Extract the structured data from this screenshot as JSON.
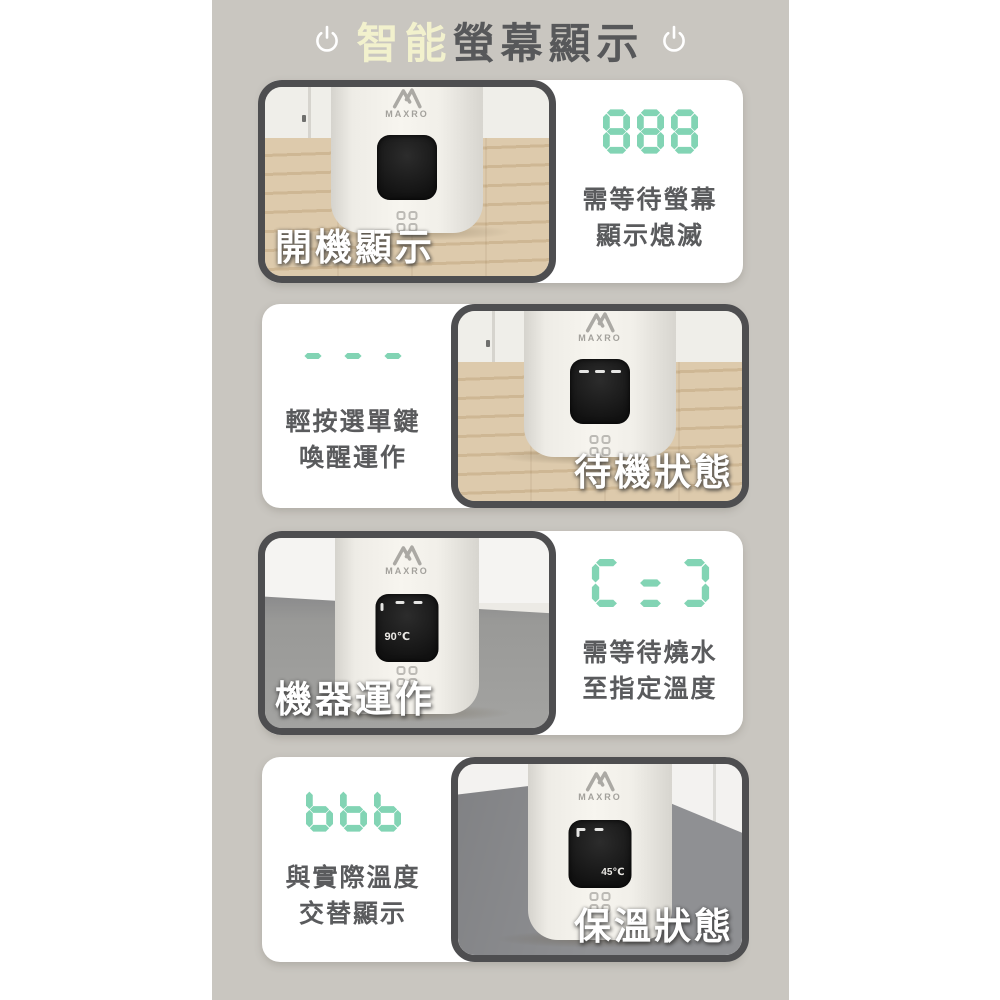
{
  "title": {
    "prefix_highlight": "智能",
    "rest": "螢幕顯示"
  },
  "brand": {
    "logo_text": "MAXRO"
  },
  "colors": {
    "canvas": "#c9c6c0",
    "accent": "#82d4b4",
    "title_highlight": "#f2f1cd",
    "title_text": "#57585a",
    "caption_text": "#5a5b5d",
    "photo_border": "#4e4e50",
    "card_bg": "#ffffff"
  },
  "sections": [
    {
      "id": "power-on",
      "photo_label": "開機顯示",
      "display_glyphs": "888",
      "caption_line1": "需等待螢幕",
      "caption_line2": "顯示熄滅",
      "screen_text": ""
    },
    {
      "id": "standby",
      "photo_label": "待機狀態",
      "display_glyphs": "---",
      "caption_line1": "輕按選單鍵",
      "caption_line2": "喚醒運作",
      "screen_text": "---"
    },
    {
      "id": "operating",
      "photo_label": "機器運作",
      "display_glyphs": "C=Ɔ",
      "caption_line1": "需等待燒水",
      "caption_line2": "至指定溫度",
      "screen_text": "90℃"
    },
    {
      "id": "keep-warm",
      "photo_label": "保溫狀態",
      "display_glyphs": "bbb",
      "caption_line1": "與實際溫度",
      "caption_line2": "交替顯示",
      "screen_text": "45℃"
    }
  ]
}
